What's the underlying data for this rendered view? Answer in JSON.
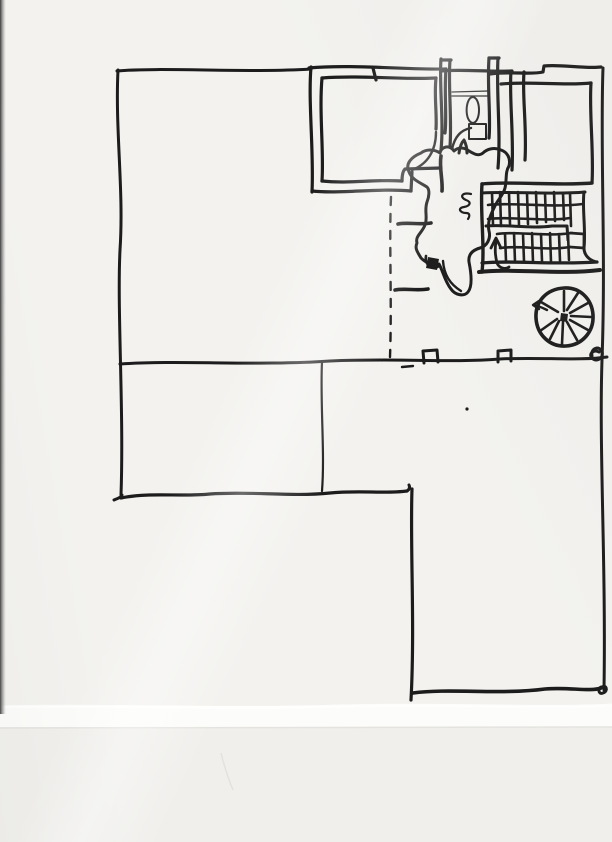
{
  "document": {
    "kind": "hand-drawn architectural floor plan sketch",
    "medium": "black ink on scanned paper",
    "visible_text": "none (only a small illegible scribbled mark beside the staircase)"
  },
  "colors": {
    "ink": "#1c1c1c",
    "paper": "#f3f2ef",
    "paper_lower_strip": "#f0efec",
    "paper_edge_highlight": "#fcfcfa",
    "scan_edge_shadow": "#474747",
    "crease": "#e2e1dd"
  },
  "plan_features": [
    {
      "id": "outer-walls",
      "label": "building outline walls"
    },
    {
      "id": "upper-left-room",
      "label": "double-walled room top left with door swing at lower right"
    },
    {
      "id": "wc-room",
      "label": "narrow service room with oval and rectangular fixtures and door swing"
    },
    {
      "id": "upper-right-room",
      "label": "double-walled room top right"
    },
    {
      "id": "dogleg-stair",
      "label": "U-return staircase with hatched treads and up arrow"
    },
    {
      "id": "spiral-stair",
      "label": "spiral staircase with radial treads and entry arrow"
    },
    {
      "id": "hall-blob",
      "label": "free-form hall / landing outline in plan center"
    },
    {
      "id": "dashed-partition",
      "label": "dashed partition line"
    },
    {
      "id": "mid-wall-columns",
      "label": "long middle wall with two column marks and scribbled corner knot"
    },
    {
      "id": "lower-left-room",
      "label": "large open room lower left"
    },
    {
      "id": "lower-right-room",
      "label": "open room lower right"
    },
    {
      "id": "scribble-mark",
      "label": "small illegible handwritten mark beside stair"
    }
  ]
}
